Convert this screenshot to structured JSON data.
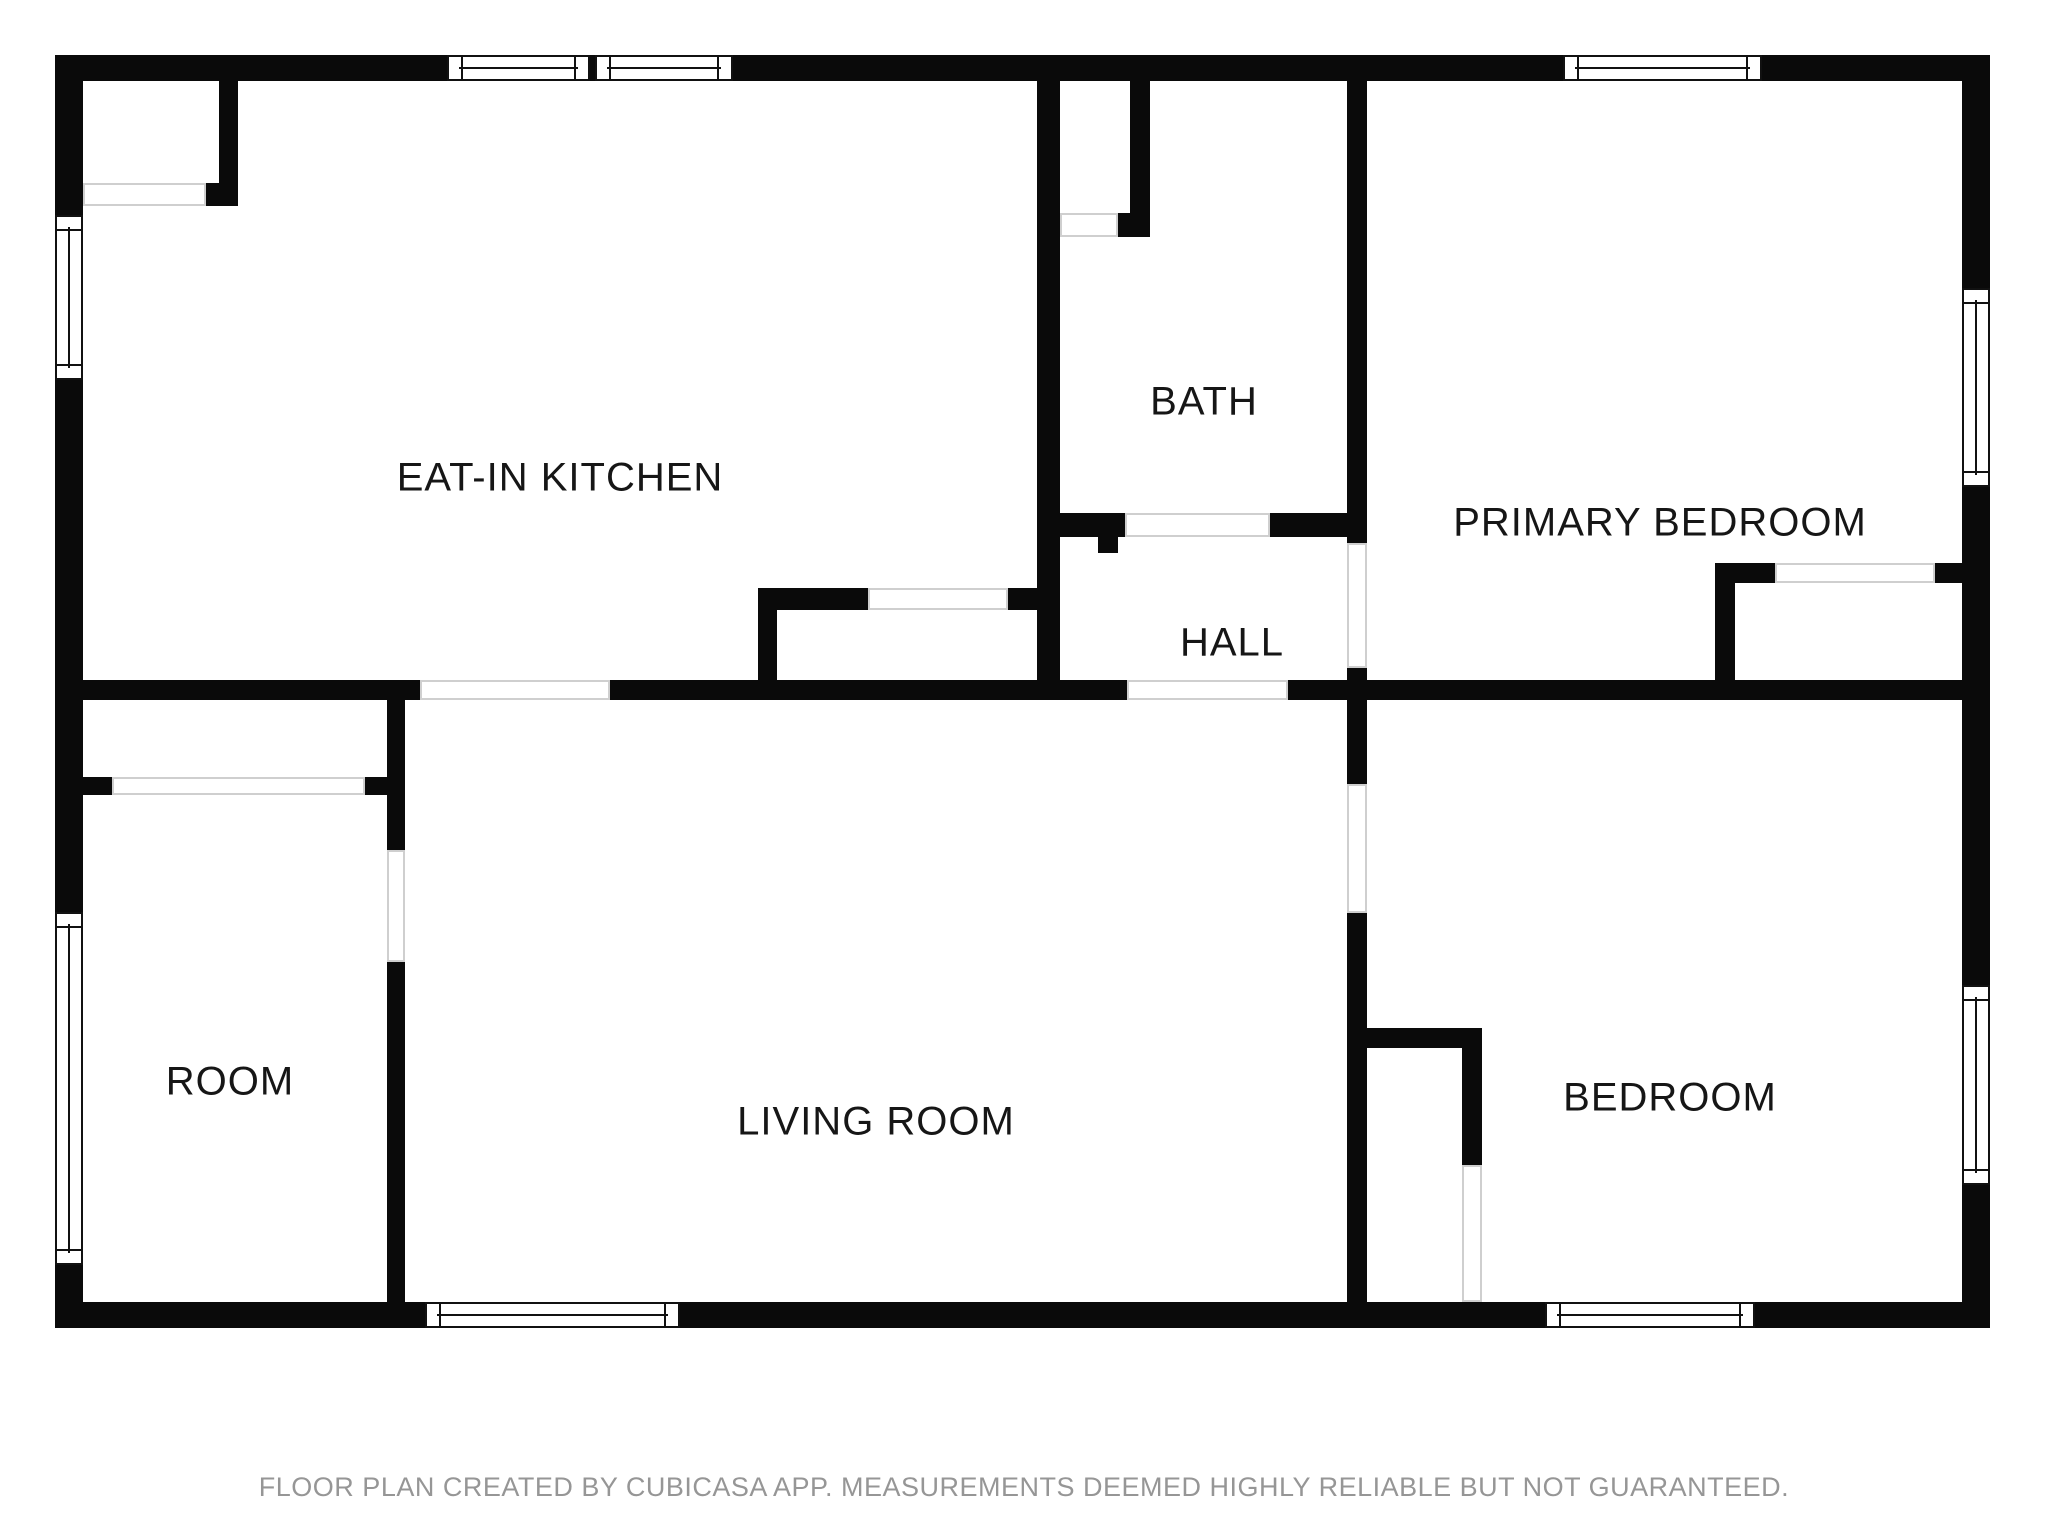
{
  "footer": {
    "text": "FLOOR PLAN CREATED BY CUBICASA APP. MEASUREMENTS DEEMED HIGHLY RELIABLE BUT NOT GUARANTEED."
  },
  "plan": {
    "colors": {
      "background": "#ffffff",
      "wall": "#0a0a0a",
      "window_frame": "#111111",
      "opening_line": "#cfcfcf",
      "label": "#161616",
      "footer": "#969696"
    },
    "rooms": [
      {
        "name": "eat-in-kitchen",
        "label": "EAT-IN KITCHEN",
        "x": 560,
        "y": 478
      },
      {
        "name": "bath",
        "label": "BATH",
        "x": 1204,
        "y": 402
      },
      {
        "name": "primary-bedroom",
        "label": "PRIMARY BEDROOM",
        "x": 1660,
        "y": 523
      },
      {
        "name": "hall",
        "label": "HALL",
        "x": 1232,
        "y": 643
      },
      {
        "name": "room",
        "label": "ROOM",
        "x": 230,
        "y": 1082
      },
      {
        "name": "living-room",
        "label": "LIVING ROOM",
        "x": 876,
        "y": 1122
      },
      {
        "name": "bedroom",
        "label": "BEDROOM",
        "x": 1670,
        "y": 1098
      }
    ],
    "walls": [
      {
        "x": 55,
        "y": 55,
        "w": 1935,
        "h": 26
      },
      {
        "x": 55,
        "y": 1302,
        "w": 1935,
        "h": 26
      },
      {
        "x": 55,
        "y": 55,
        "w": 28,
        "h": 1273
      },
      {
        "x": 1962,
        "y": 55,
        "w": 28,
        "h": 1273
      },
      {
        "x": 219,
        "y": 81,
        "w": 19,
        "h": 102
      },
      {
        "x": 204,
        "y": 183,
        "w": 34,
        "h": 23
      },
      {
        "x": 55,
        "y": 680,
        "w": 365,
        "h": 20
      },
      {
        "x": 610,
        "y": 680,
        "w": 517,
        "h": 20
      },
      {
        "x": 1288,
        "y": 680,
        "w": 79,
        "h": 20
      },
      {
        "x": 1367,
        "y": 680,
        "w": 595,
        "h": 20
      },
      {
        "x": 387,
        "y": 700,
        "w": 18,
        "h": 150
      },
      {
        "x": 387,
        "y": 962,
        "w": 18,
        "h": 340
      },
      {
        "x": 83,
        "y": 777,
        "w": 29,
        "h": 18
      },
      {
        "x": 365,
        "y": 777,
        "w": 22,
        "h": 18
      },
      {
        "x": 758,
        "y": 588,
        "w": 110,
        "h": 22
      },
      {
        "x": 1008,
        "y": 588,
        "w": 32,
        "h": 22
      },
      {
        "x": 758,
        "y": 610,
        "w": 19,
        "h": 70
      },
      {
        "x": 1037,
        "y": 81,
        "w": 23,
        "h": 599
      },
      {
        "x": 1130,
        "y": 81,
        "w": 20,
        "h": 132
      },
      {
        "x": 1118,
        "y": 213,
        "w": 32,
        "h": 24
      },
      {
        "x": 1058,
        "y": 513,
        "w": 67,
        "h": 24
      },
      {
        "x": 1098,
        "y": 537,
        "w": 20,
        "h": 16
      },
      {
        "x": 1270,
        "y": 513,
        "w": 97,
        "h": 24
      },
      {
        "x": 1347,
        "y": 81,
        "w": 20,
        "h": 462
      },
      {
        "x": 1347,
        "y": 668,
        "w": 20,
        "h": 116
      },
      {
        "x": 1347,
        "y": 913,
        "w": 20,
        "h": 415
      },
      {
        "x": 1715,
        "y": 563,
        "w": 60,
        "h": 20
      },
      {
        "x": 1715,
        "y": 583,
        "w": 20,
        "h": 117
      },
      {
        "x": 1935,
        "y": 563,
        "w": 27,
        "h": 20
      },
      {
        "x": 1367,
        "y": 1028,
        "w": 115,
        "h": 20
      },
      {
        "x": 1462,
        "y": 1048,
        "w": 20,
        "h": 117
      }
    ],
    "windows": [
      {
        "x": 447,
        "y": 55,
        "w": 143,
        "h": 26,
        "orientation": "h"
      },
      {
        "x": 595,
        "y": 55,
        "w": 138,
        "h": 26,
        "orientation": "h"
      },
      {
        "x": 1563,
        "y": 55,
        "w": 199,
        "h": 26,
        "orientation": "h"
      },
      {
        "x": 1962,
        "y": 288,
        "w": 28,
        "h": 199,
        "orientation": "v"
      },
      {
        "x": 55,
        "y": 215,
        "w": 28,
        "h": 165,
        "orientation": "v"
      },
      {
        "x": 55,
        "y": 912,
        "w": 28,
        "h": 353,
        "orientation": "v"
      },
      {
        "x": 425,
        "y": 1302,
        "w": 255,
        "h": 26,
        "orientation": "h"
      },
      {
        "x": 1545,
        "y": 1302,
        "w": 210,
        "h": 26,
        "orientation": "h"
      },
      {
        "x": 1962,
        "y": 985,
        "w": 28,
        "h": 200,
        "orientation": "v"
      }
    ],
    "openings": [
      {
        "x": 83,
        "y": 183,
        "w": 123,
        "h": 23
      },
      {
        "x": 420,
        "y": 680,
        "w": 190,
        "h": 20
      },
      {
        "x": 1127,
        "y": 680,
        "w": 161,
        "h": 20
      },
      {
        "x": 112,
        "y": 777,
        "w": 253,
        "h": 18
      },
      {
        "x": 868,
        "y": 588,
        "w": 140,
        "h": 22
      },
      {
        "x": 1060,
        "y": 213,
        "w": 58,
        "h": 24
      },
      {
        "x": 1125,
        "y": 513,
        "w": 145,
        "h": 24
      },
      {
        "x": 1347,
        "y": 543,
        "w": 20,
        "h": 125
      },
      {
        "x": 1347,
        "y": 784,
        "w": 20,
        "h": 129
      },
      {
        "x": 387,
        "y": 850,
        "w": 18,
        "h": 112
      },
      {
        "x": 1775,
        "y": 563,
        "w": 160,
        "h": 20
      },
      {
        "x": 1462,
        "y": 1165,
        "w": 20,
        "h": 137
      }
    ]
  }
}
